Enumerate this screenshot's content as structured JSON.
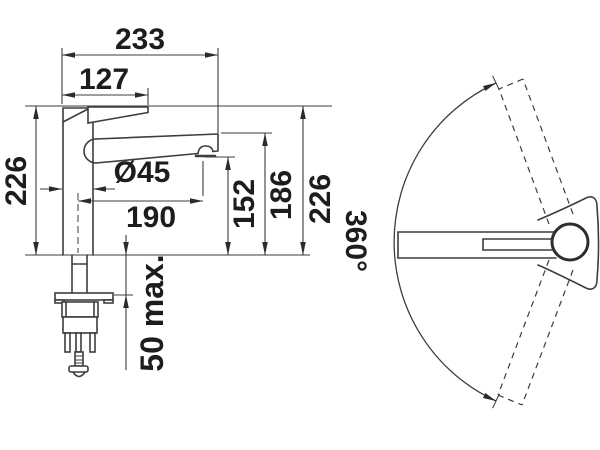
{
  "drawing": {
    "title": "kitchen faucet technical dimension drawing",
    "units": "mm",
    "colors": {
      "line": "#3d3d3d",
      "text": "#1d1d1d",
      "background": "#ffffff"
    },
    "side_view": {
      "reach": "233",
      "handle_reach": "127",
      "height_left": "226",
      "body_diameter": "Ø45",
      "aerator_reach": "190",
      "aerator_height": "152",
      "spout_tip_height": "186",
      "height_right": "226",
      "max_mount_thickness": "50 max."
    },
    "top_view": {
      "swivel_angle": "360°"
    }
  }
}
